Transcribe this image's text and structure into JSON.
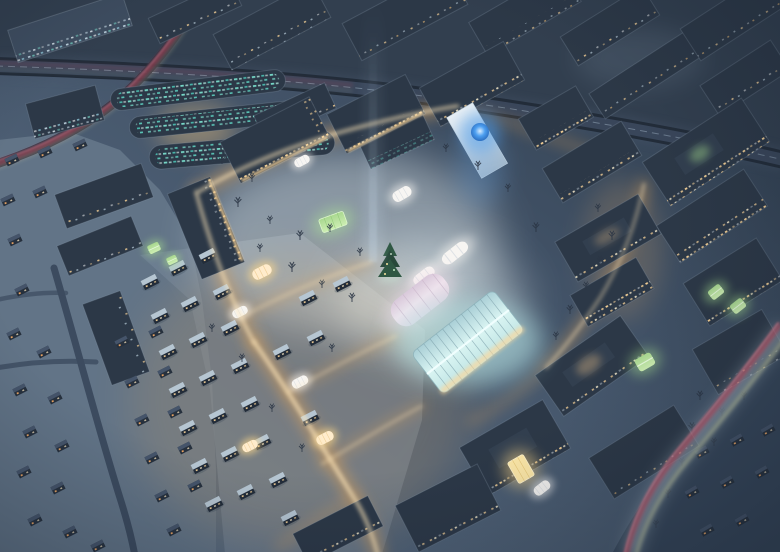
{
  "meta": {
    "domain": "Natural-Image",
    "title": "Snowy town at night - aerial architectural rendering",
    "type": "architectural visualization",
    "season": "winter",
    "time_of_day": "night",
    "view": "bird's-eye aerial"
  },
  "scene": {
    "description": "Aerial night view of a snow-covered town. A glowing central plaza with a Christmas tree, illuminated barrel-vaulted market tents and a large glass market hall is ringed by mid-rise blocks with warmly lit windows. Orange-lit pedestrian streets radiate through a village of small snowy houses toward a dark suburb of detached houses at lower left. An elevated highway crosses the upper part of the image; roads with red and amber car-light trails curve at the top left and bottom right. A faint vertical light beam and a blue glowing orb on a light tower rise beside the square, and office slabs with teal-lit windows sit below the highway.",
    "landmarks": [
      {
        "id": "central-plaza",
        "label": "Central snow-covered plaza with bare trees"
      },
      {
        "id": "christmas-tree",
        "label": "Christmas tree on the plaza"
      },
      {
        "id": "glass-market-hall",
        "label": "Glowing barrel-vaulted glass market hall"
      },
      {
        "id": "market-tents",
        "label": "Illuminated white and pink market tents"
      },
      {
        "id": "green-glass-pavilion",
        "label": "Green glowing glass pavilions and courtyard greenhouses"
      },
      {
        "id": "blue-light-orb",
        "label": "Blue glowing orb on a light tower"
      },
      {
        "id": "sky-light-beam",
        "label": "Vertical searchlight beam over the square"
      },
      {
        "id": "elevated-highway",
        "label": "Elevated highway crossing the upper half"
      },
      {
        "id": "access-road-light-trails",
        "label": "Top-left road with red car-light trails"
      },
      {
        "id": "ring-road-light-trails",
        "label": "Bottom-right curving road with red and amber light trails"
      },
      {
        "id": "office-buildings-teal",
        "label": "Office slabs with teal-lit windows"
      },
      {
        "id": "village-district",
        "label": "Lit village streets with small snowy houses"
      },
      {
        "id": "suburb",
        "label": "Dark suburb of detached snowy houses"
      }
    ]
  },
  "palette": {
    "bg_top": "#2c3a4a",
    "bg_bottom": "#5d7085",
    "city_dark": "#323f4f",
    "suburb_snow": "#627487",
    "suburb_snow2": "#76889c",
    "snow_corner_dark": "#36465a",
    "roof_dark": "#2c3847",
    "roof_mid": "#3e4d60",
    "facade": "#232e3c",
    "win_warm": "#ffd89a",
    "win_bright": "#fff3d2",
    "win_teal": "#7de8d4",
    "win_cool": "#cfe4f0",
    "glow_street": "#e2a458",
    "glow_core": "#ffe8bc",
    "plaza_white": "#eaf2f2",
    "glass_cyan": "#d9f4f2",
    "glass_glow": "#bdeeee",
    "tent_white": "#f7f5f2",
    "tent_pink": "#f0e2ec",
    "green_glass": "#cdeeb2",
    "tree_dark": "#2b3645",
    "conifer": "#2f5743",
    "orb_blue": "#4d9ff0",
    "beam_blue": "#cfe2f2",
    "trail_red": "#e04b5e",
    "trail_pink": "#ff8fa0",
    "trail_amber": "#e0e4ae",
    "road_dark": "#222c39",
    "road_surface": "#39465a",
    "road_suburb": "#3c4b5f"
  }
}
